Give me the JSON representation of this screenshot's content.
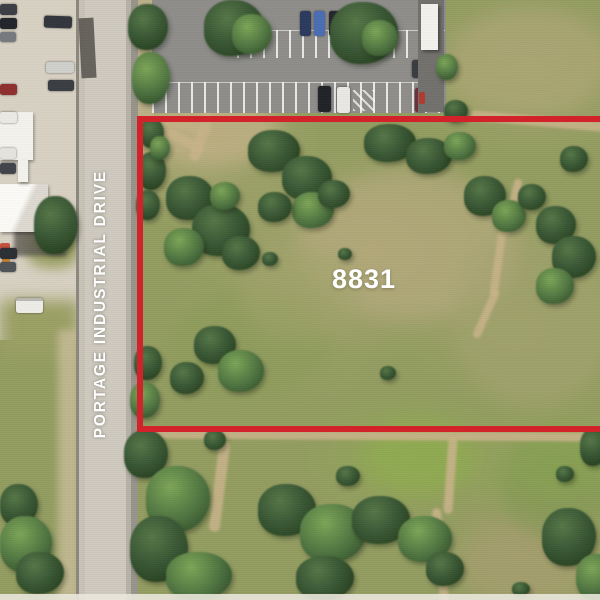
{
  "map": {
    "parcel": {
      "label": "8831"
    },
    "road": {
      "label": "PORTAGE INDUSTRIAL DRIVE"
    },
    "boundary": {
      "color": "#d2232a"
    },
    "label_color": "#ffffff"
  }
}
